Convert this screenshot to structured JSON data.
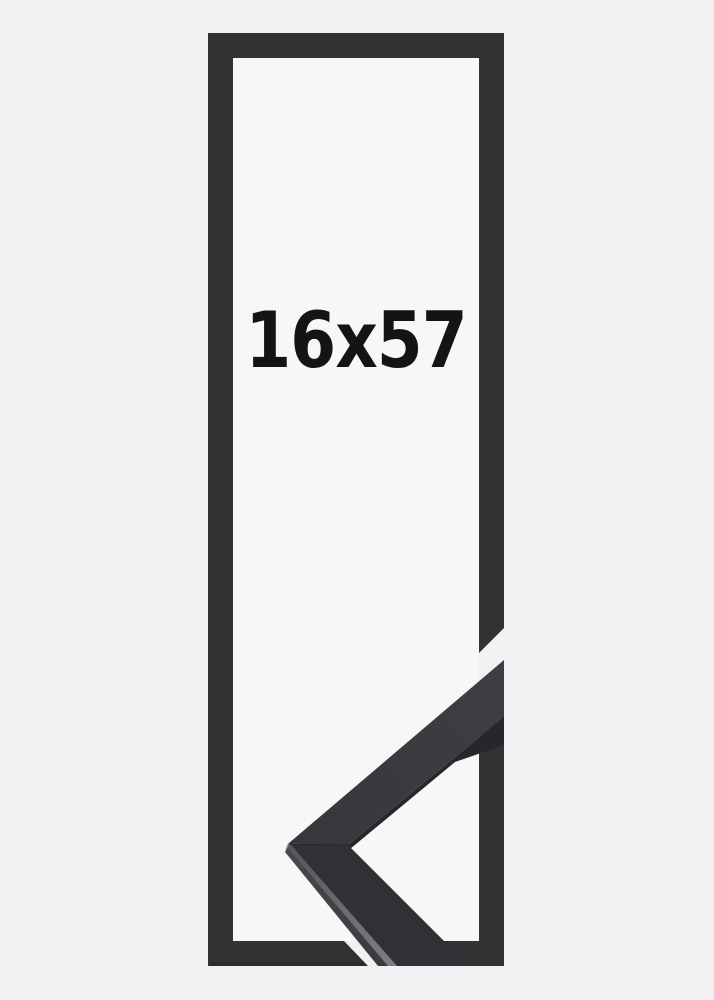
{
  "product": {
    "size_label": "16x57"
  },
  "colors": {
    "background": "#f1f1f3",
    "opening": "#f7f7f8",
    "frame": "#303234",
    "frame_shadow": "#1f2123",
    "face_upper_start": "#35373a",
    "face_upper_end": "#3d3f42",
    "face_lower": "#2f3134",
    "side_face_start": "#47494c",
    "side_face_end": "#393b3e",
    "edge_highlight_start": "#54565a",
    "edge_highlight_end": "#7c7e82",
    "underside": "#25272a",
    "miter_seam": "#232528",
    "label_text": "#141414"
  }
}
